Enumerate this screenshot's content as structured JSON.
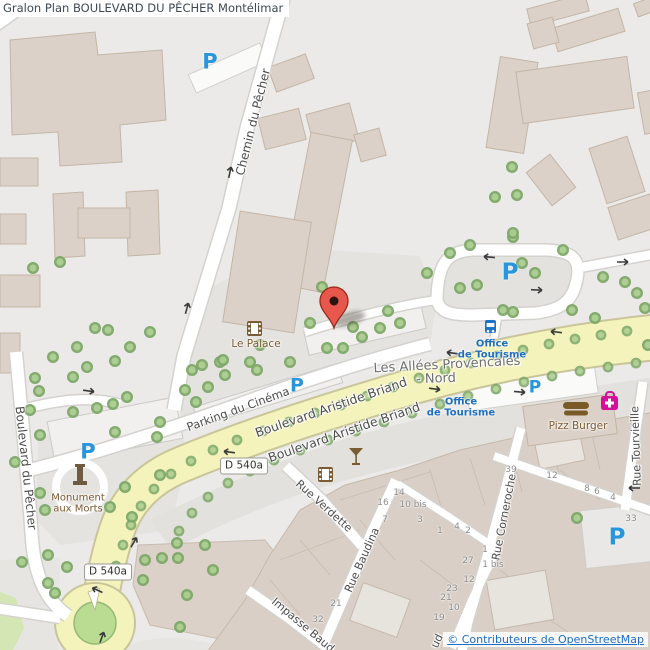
{
  "title": "Gralon Plan BOULEVARD DU PÊCHER Montélimar",
  "attribution": {
    "text": "© Contributeurs de OpenStreetMap"
  },
  "colors": {
    "background": "#EBEAE8",
    "building": "#DBD1C8",
    "building_stroke": "#C4B5A6",
    "road_yellow": "#F5F3BC",
    "tree_fill": "#AACD8E",
    "tree_ring": "#7EA769",
    "parking_blue": "#2796DC",
    "tourism_blue": "#1E6FBF",
    "poi_brown": "#7A5B33",
    "pharmacy_magenta": "#D5119B",
    "marker_red": "#E8574B",
    "copyright_blue": "#1B6EC8"
  },
  "road_refs": [
    {
      "text": "D 540a",
      "x": 244,
      "y": 466
    },
    {
      "text": "D 540a",
      "x": 108,
      "y": 572
    }
  ],
  "street_labels": [
    {
      "text": "Chemin du Pêcher",
      "x": 253,
      "y": 122,
      "rot": -76,
      "size": 12
    },
    {
      "text": "Boulevard du Pêcher",
      "x": 26,
      "y": 468,
      "rot": 84,
      "size": 12
    },
    {
      "text": "Parking du Cinéma",
      "x": 238,
      "y": 409,
      "rot": -20,
      "size": 11.5
    },
    {
      "text": "Boulevard Aristide Briand",
      "x": 331,
      "y": 407,
      "rot": -19,
      "size": 12.5
    },
    {
      "text": "Boulevard Aristide Briand",
      "x": 344,
      "y": 432,
      "rot": -19,
      "size": 12.5
    },
    {
      "text": "Rue Verdette",
      "x": 324,
      "y": 506,
      "rot": 42,
      "size": 11
    },
    {
      "text": "Rue Baudina",
      "x": 362,
      "y": 560,
      "rot": -66,
      "size": 11
    },
    {
      "text": "Impasse Baud",
      "x": 303,
      "y": 625,
      "rot": 40,
      "size": 11
    },
    {
      "text": "Rue Corneroche",
      "x": 504,
      "y": 517,
      "rot": -79,
      "size": 11
    },
    {
      "text": "Rue Tourvieille",
      "x": 636,
      "y": 446,
      "rot": -92,
      "size": 11
    },
    {
      "text": "ud",
      "x": 437,
      "y": 641,
      "rot": -65,
      "size": 11
    },
    {
      "text": "Les Allées Provencales",
      "x": 447,
      "y": 365,
      "rot": -3,
      "size": 13,
      "kind": "area"
    },
    {
      "text": "- Nord",
      "x": 436,
      "y": 379,
      "rot": -2,
      "size": 13,
      "kind": "area"
    }
  ],
  "pois": {
    "cinema": {
      "label": "Le Palace"
    },
    "monument": {
      "line1": "Monument",
      "line2": "aux Morts"
    },
    "tourism_office_north": {
      "line1": "Office",
      "line2": "de Tourisme"
    },
    "tourism_office_south": {
      "line1": "Office",
      "line2": "de Tourisme"
    },
    "fast_food": {
      "label": "Pizz Burger"
    }
  },
  "parking_marks": [
    {
      "x": 210,
      "y": 62,
      "size": 21
    },
    {
      "x": 510,
      "y": 273,
      "size": 23
    },
    {
      "x": 297,
      "y": 386,
      "size": 19
    },
    {
      "x": 88,
      "y": 452,
      "size": 21
    },
    {
      "x": 535,
      "y": 388,
      "size": 17
    },
    {
      "x": 617,
      "y": 538,
      "size": 23
    }
  ],
  "house_numbers": [
    {
      "n": "39",
      "x": 511,
      "y": 470
    },
    {
      "n": "12",
      "x": 552,
      "y": 476
    },
    {
      "n": "8",
      "x": 587,
      "y": 489
    },
    {
      "n": "6",
      "x": 597,
      "y": 492
    },
    {
      "n": "4",
      "x": 613,
      "y": 498
    },
    {
      "n": "33",
      "x": 631,
      "y": 519
    },
    {
      "n": "14",
      "x": 399,
      "y": 493
    },
    {
      "n": "16",
      "x": 383,
      "y": 503
    },
    {
      "n": "10 bis",
      "x": 413,
      "y": 505
    },
    {
      "n": "7",
      "x": 385,
      "y": 520
    },
    {
      "n": "3",
      "x": 420,
      "y": 520
    },
    {
      "n": "1",
      "x": 440,
      "y": 531
    },
    {
      "n": "4",
      "x": 457,
      "y": 527
    },
    {
      "n": "2",
      "x": 468,
      "y": 531
    },
    {
      "n": "1",
      "x": 485,
      "y": 550
    },
    {
      "n": "27",
      "x": 468,
      "y": 561
    },
    {
      "n": "1 bis",
      "x": 493,
      "y": 565
    },
    {
      "n": "12",
      "x": 469,
      "y": 580
    },
    {
      "n": "23",
      "x": 452,
      "y": 589
    },
    {
      "n": "21",
      "x": 446,
      "y": 598
    },
    {
      "n": "10",
      "x": 454,
      "y": 608
    },
    {
      "n": "19",
      "x": 439,
      "y": 618
    },
    {
      "n": "21",
      "x": 336,
      "y": 604
    },
    {
      "n": "32",
      "x": 318,
      "y": 620
    }
  ],
  "trees": {
    "park": [
      [
        33,
        268
      ],
      [
        60,
        262
      ],
      [
        95,
        328
      ],
      [
        108,
        330
      ],
      [
        150,
        332
      ],
      [
        77,
        347
      ],
      [
        130,
        347
      ],
      [
        53,
        357
      ],
      [
        115,
        361
      ],
      [
        87,
        367
      ],
      [
        73,
        377
      ],
      [
        35,
        378
      ],
      [
        39,
        391
      ],
      [
        127,
        397
      ],
      [
        113,
        404
      ],
      [
        97,
        408
      ],
      [
        185,
        390
      ],
      [
        160,
        422
      ],
      [
        30,
        410
      ],
      [
        73,
        412
      ],
      [
        40,
        435
      ],
      [
        15,
        462
      ],
      [
        157,
        437
      ],
      [
        115,
        432
      ],
      [
        160,
        475
      ],
      [
        125,
        487
      ],
      [
        110,
        507
      ],
      [
        132,
        517
      ],
      [
        40,
        493
      ],
      [
        45,
        510
      ],
      [
        22,
        562
      ],
      [
        48,
        555
      ],
      [
        67,
        567
      ],
      [
        48,
        583
      ],
      [
        55,
        593
      ],
      [
        192,
        370
      ],
      [
        202,
        365
      ],
      [
        220,
        362
      ],
      [
        250,
        362
      ],
      [
        257,
        370
      ],
      [
        225,
        375
      ],
      [
        208,
        387
      ],
      [
        196,
        402
      ],
      [
        223,
        360
      ],
      [
        260,
        345
      ],
      [
        290,
        362
      ],
      [
        322,
        287
      ],
      [
        310,
        323
      ],
      [
        327,
        348
      ],
      [
        343,
        348
      ],
      [
        353,
        327
      ],
      [
        362,
        337
      ],
      [
        380,
        328
      ],
      [
        400,
        323
      ],
      [
        388,
        311
      ],
      [
        450,
        253
      ],
      [
        470,
        245
      ],
      [
        513,
        237
      ],
      [
        563,
        250
      ],
      [
        427,
        273
      ],
      [
        460,
        288
      ],
      [
        477,
        285
      ],
      [
        535,
        273
      ],
      [
        603,
        277
      ],
      [
        625,
        282
      ],
      [
        637,
        293
      ],
      [
        572,
        310
      ],
      [
        595,
        318
      ],
      [
        522,
        263
      ],
      [
        513,
        312
      ],
      [
        503,
        310
      ],
      [
        512,
        167
      ],
      [
        495,
        197
      ],
      [
        517,
        195
      ],
      [
        513,
        233
      ],
      [
        177,
        543
      ],
      [
        205,
        545
      ],
      [
        162,
        558
      ],
      [
        178,
        558
      ],
      [
        213,
        570
      ],
      [
        143,
        580
      ],
      [
        187,
        595
      ],
      [
        180,
        627
      ],
      [
        145,
        560
      ],
      [
        577,
        518
      ],
      [
        648,
        345
      ],
      [
        645,
        308
      ]
    ],
    "street": [
      [
        627,
        331
      ],
      [
        601,
        335
      ],
      [
        575,
        339
      ],
      [
        549,
        344
      ],
      [
        523,
        350
      ],
      [
        497,
        356
      ],
      [
        471,
        363
      ],
      [
        445,
        370
      ],
      [
        419,
        378
      ],
      [
        393,
        387
      ],
      [
        367,
        396
      ],
      [
        341,
        405
      ],
      [
        315,
        413
      ],
      [
        289,
        422
      ],
      [
        263,
        431
      ],
      [
        237,
        440
      ],
      [
        213,
        450
      ],
      [
        191,
        461
      ],
      [
        171,
        474
      ],
      [
        154,
        489
      ],
      [
        141,
        506
      ],
      [
        131,
        525
      ],
      [
        123,
        545
      ],
      [
        116,
        566
      ],
      [
        636,
        363
      ],
      [
        608,
        367
      ],
      [
        580,
        371
      ],
      [
        552,
        376
      ],
      [
        524,
        382
      ],
      [
        496,
        389
      ],
      [
        468,
        396
      ],
      [
        440,
        404
      ],
      [
        412,
        413
      ],
      [
        384,
        422
      ],
      [
        356,
        431
      ],
      [
        328,
        440
      ],
      [
        300,
        450
      ],
      [
        274,
        460
      ],
      [
        250,
        471
      ],
      [
        228,
        483
      ],
      [
        208,
        497
      ],
      [
        192,
        513
      ],
      [
        179,
        531
      ]
    ]
  }
}
